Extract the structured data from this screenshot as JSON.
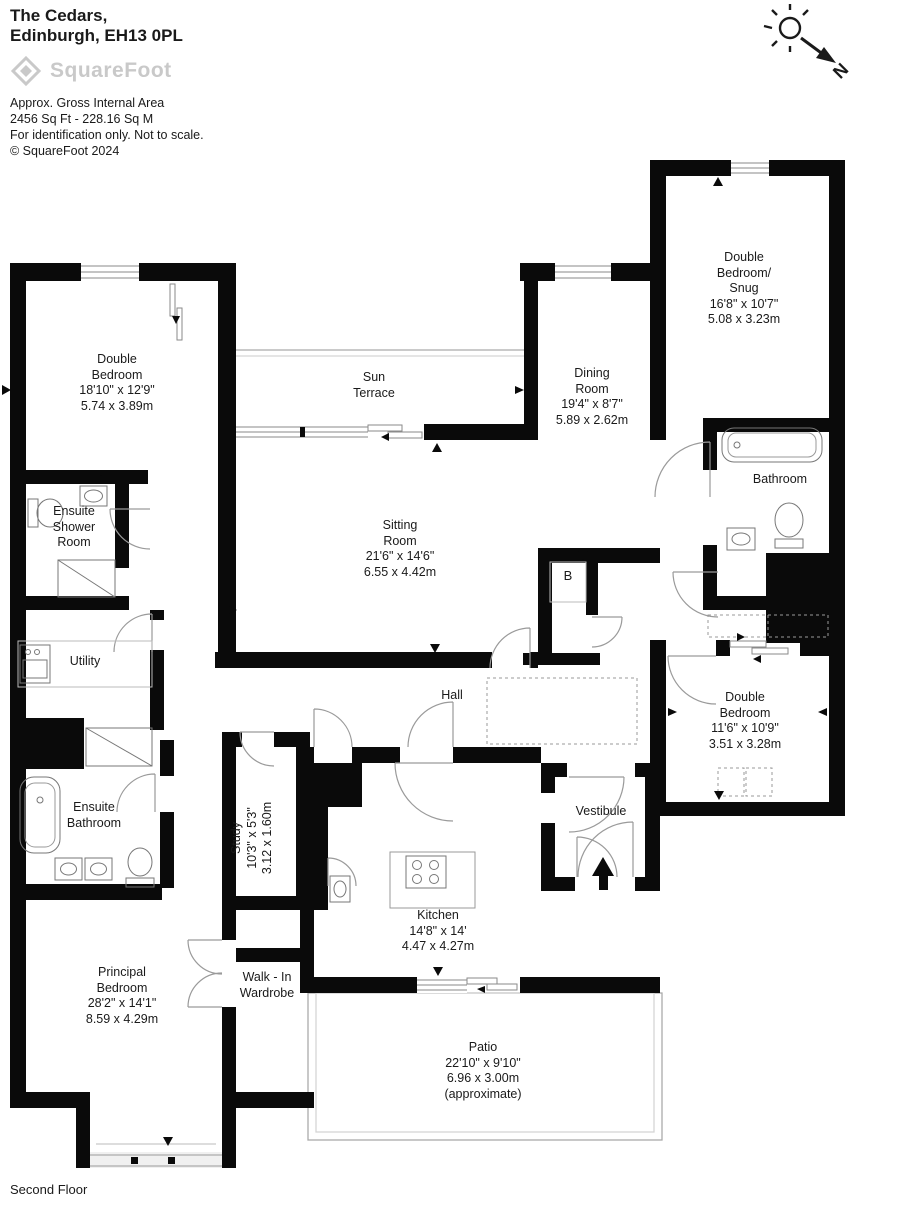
{
  "header": {
    "title_line1": "The Cedars,",
    "title_line2": "Edinburgh, EH13 0PL",
    "logo_text": "SquareFoot",
    "area_label": "Approx. Gross Internal Area",
    "area_value": "2456 Sq Ft  -  228.16 Sq M",
    "disclaimer": "For identification only. Not to scale.",
    "copyright": "© SquareFoot 2024"
  },
  "compass": {
    "north_label": "N"
  },
  "floor_label": "Second Floor",
  "boiler_label": "B",
  "colors": {
    "wall": "#0a0a0a",
    "line_gray": "#999999",
    "logo_gray": "#c9c9c9"
  },
  "rooms": {
    "double_bedroom_nw": {
      "name_lines": [
        "Double",
        "Bedroom"
      ],
      "dim_imperial": "18'10\" x 12'9\"",
      "dim_metric": "5.74 x 3.89m"
    },
    "sun_terrace": {
      "name_lines": [
        "Sun",
        "Terrace"
      ]
    },
    "dining_room": {
      "name_lines": [
        "Dining",
        "Room"
      ],
      "dim_imperial": "19'4\" x 8'7\"",
      "dim_metric": "5.89 x 2.62m"
    },
    "double_bedroom_snug": {
      "name_lines": [
        "Double",
        "Bedroom/",
        "Snug"
      ],
      "dim_imperial": "16'8\" x 10'7\"",
      "dim_metric": "5.08 x 3.23m"
    },
    "sitting_room": {
      "name_lines": [
        "Sitting",
        "Room"
      ],
      "dim_imperial": "21'6\" x 14'6\"",
      "dim_metric": "6.55 x 4.42m"
    },
    "bathroom": {
      "name_lines": [
        "Bathroom"
      ]
    },
    "ensuite_shower_room": {
      "name_lines": [
        "Ensuite",
        "Shower",
        "Room"
      ]
    },
    "utility": {
      "name_lines": [
        "Utility"
      ]
    },
    "hall": {
      "name_lines": [
        "Hall"
      ]
    },
    "double_bedroom_e": {
      "name_lines": [
        "Double",
        "Bedroom"
      ],
      "dim_imperial": "11'6\" x 10'9\"",
      "dim_metric": "3.51 x 3.28m"
    },
    "ensuite_bathroom": {
      "name_lines": [
        "Ensuite",
        "Bathroom"
      ]
    },
    "study": {
      "name_lines": [
        "Study"
      ],
      "dim_imperial": "10'3\" x 5'3\"",
      "dim_metric": "3.12 x 1.60m"
    },
    "kitchen": {
      "name_lines": [
        "Kitchen"
      ],
      "dim_imperial": "14'8\" x 14'",
      "dim_metric": "4.47 x 4.27m"
    },
    "vestibule": {
      "name_lines": [
        "Vestibule"
      ]
    },
    "principal_bedroom": {
      "name_lines": [
        "Principal",
        "Bedroom"
      ],
      "dim_imperial": "28'2\" x 14'1\"",
      "dim_metric": "8.59 x 4.29m"
    },
    "walk_in_wardrobe": {
      "name_lines": [
        "Walk - In",
        "Wardrobe"
      ]
    },
    "patio": {
      "name_lines": [
        "Patio"
      ],
      "dim_imperial": "22'10\" x 9'10\"",
      "dim_metric": "6.96 x 3.00m",
      "note": "(approximate)"
    }
  }
}
